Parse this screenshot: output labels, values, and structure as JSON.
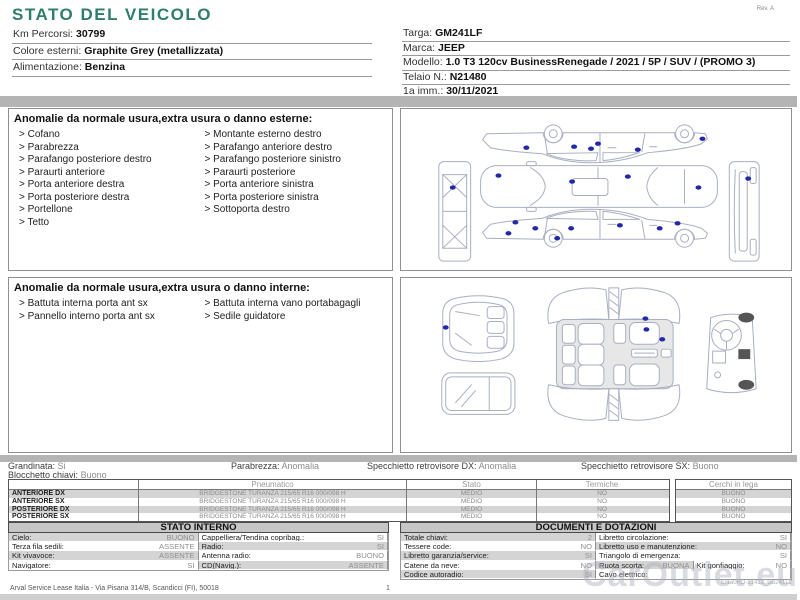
{
  "colors": {
    "accent": "#2f7d6e",
    "bar": "#b4b4b4",
    "dot": "#2328a8",
    "row_shade": "#d4d4d4"
  },
  "header": {
    "title": "STATO DEL VEICOLO",
    "rev": "Rev. A",
    "left_fields": [
      {
        "label": "Km Percorsi:",
        "value": "30799"
      },
      {
        "label": "Colore esterni:",
        "value": "Graphite Grey (metallizzata)"
      },
      {
        "label": "Alimentazione:",
        "value": "Benzina"
      }
    ],
    "right_fields": [
      {
        "label": "Targa:",
        "value": "GM241LF"
      },
      {
        "label": "Marca:",
        "value": "JEEP"
      },
      {
        "label": "Modello:",
        "value": "1.0 T3 120cv BusinessRenegade / 2021 / 5P / SUV / (PROMO 3)"
      },
      {
        "label": "Telaio N.:",
        "value": "N21480"
      },
      {
        "label": "1a imm.:",
        "value": "30/11/2021"
      }
    ]
  },
  "exterior_anomalies": {
    "title": "Anomalie da normale usura,extra usura o danno esterne:",
    "col1": [
      "Cofano",
      "Parabrezza",
      "Parafango posteriore destro",
      "Paraurti anteriore",
      "Porta anteriore destra",
      "Porta posteriore destra",
      "Portellone",
      "Tetto"
    ],
    "col2": [
      "Montante esterno destro",
      "Parafango anteriore destro",
      "Parafango posteriore sinistro",
      "Paraurti posteriore",
      "Porta anteriore sinistra",
      "Porta posteriore sinistra",
      "Sottoporta destro"
    ]
  },
  "interior_anomalies": {
    "title": "Anomalie da normale usura,extra usura o danno interne:",
    "col1": [
      "Battuta interna porta ant sx",
      "Pannello interno porta ant sx"
    ],
    "col2": [
      "Battuta interna vano portabagagli",
      "Sedile guidatore"
    ]
  },
  "diagrams": {
    "exterior_damage_points": [
      [
        126,
        38
      ],
      [
        174,
        37
      ],
      [
        191,
        39
      ],
      [
        198,
        34
      ],
      [
        238,
        40
      ],
      [
        303,
        29
      ],
      [
        98,
        66
      ],
      [
        172,
        72
      ],
      [
        228,
        67
      ],
      [
        299,
        78
      ],
      [
        52,
        78
      ],
      [
        349,
        69
      ],
      [
        108,
        124
      ],
      [
        115,
        113
      ],
      [
        135,
        119
      ],
      [
        157,
        129
      ],
      [
        171,
        119
      ],
      [
        220,
        116
      ],
      [
        260,
        119
      ],
      [
        278,
        114
      ]
    ],
    "interior_damage_points": [
      [
        44,
        50
      ],
      [
        246,
        41
      ],
      [
        247,
        52
      ],
      [
        263,
        62
      ]
    ]
  },
  "summary": {
    "line1": [
      {
        "label": "Grandinata:",
        "value": "Si"
      },
      {
        "label": "Parabrezza:",
        "value": "Anomalia"
      },
      {
        "label": "Specchietto retrovisore DX:",
        "value": "Anomalia"
      },
      {
        "label": "Specchietto retrovisore SX:",
        "value": "Buono"
      }
    ],
    "line2": [
      {
        "label": "Blocchetto chiavi:",
        "value": "Buono"
      }
    ]
  },
  "tyres": {
    "headers": {
      "pneumatico": "Pneumatico",
      "stato": "Stato",
      "termiche": "Termiche",
      "cerchi": "Cerchi in lega"
    },
    "rows": [
      {
        "pos": "ANTERIORE DX",
        "tyre": "BRIDGESTONE TURANZA 215/65 R16 000/098 H",
        "stato": "MEDIO",
        "termiche": "NO",
        "cerchi": "BUONO"
      },
      {
        "pos": "ANTERIORE SX",
        "tyre": "BRIDGESTONE TURANZA 215/65 R16 000/098 H",
        "stato": "MEDIO",
        "termiche": "NO",
        "cerchi": "BUONO"
      },
      {
        "pos": "POSTERIORE DX",
        "tyre": "BRIDGESTONE TURANZA 215/65 R16 000/098 H",
        "stato": "MEDIO",
        "termiche": "NO",
        "cerchi": "BUONO"
      },
      {
        "pos": "POSTERIORE SX",
        "tyre": "BRIDGESTONE TURANZA 215/65 R16 000/098 H",
        "stato": "MEDIO",
        "termiche": "NO",
        "cerchi": "BUONO"
      }
    ]
  },
  "stato_interno": {
    "title": "STATO INTERNO",
    "cells": [
      {
        "label": "Cielo:",
        "value": "BUONO",
        "w": "50%",
        "bg": "g"
      },
      {
        "label": "Cappelliera/Tendina copribag.:",
        "value": "SI",
        "w": "50%",
        "bg": "w"
      },
      {
        "label": "Terza fila sedili:",
        "value": "ASSENTE",
        "w": "50%",
        "bg": "w"
      },
      {
        "label": "Radio:",
        "value": "SI",
        "w": "50%",
        "bg": "g"
      },
      {
        "label": "Kit vivavoce:",
        "value": "ASSENTE",
        "w": "50%",
        "bg": "g"
      },
      {
        "label": "Antenna radio:",
        "value": "BUONO",
        "w": "50%",
        "bg": "w"
      },
      {
        "label": "Navigatore:",
        "value": "SI",
        "w": "50%",
        "bg": "w"
      },
      {
        "label": "CD(Navig.):",
        "value": "ASSENTE",
        "w": "50%",
        "bg": "g"
      }
    ]
  },
  "documenti": {
    "title": "DOCUMENTI E DOTAZIONI",
    "cells": [
      {
        "label": "Totale chiavi:",
        "value": "2",
        "w": "50%",
        "bg": "g"
      },
      {
        "label": "Libretto circolazione:",
        "value": "SI",
        "w": "50%",
        "bg": "w"
      },
      {
        "label": "Tessere code:",
        "value": "NO",
        "w": "50%",
        "bg": "w"
      },
      {
        "label": "Libretto uso e manutenzione:",
        "value": "NO",
        "w": "50%",
        "bg": "g"
      },
      {
        "label": "Libretto garanzia/service:",
        "value": "SI",
        "w": "50%",
        "bg": "g"
      },
      {
        "label": "Triangolo di emergenza:",
        "value": "SI",
        "w": "50%",
        "bg": "w"
      },
      {
        "label": "Catene da neve:",
        "value": "NO",
        "w": "50%",
        "bg": "w"
      },
      {
        "label": "Ruota scorta:",
        "value": "BUONA",
        "w": "25%",
        "bg": "g"
      },
      {
        "label": "Kit gonfiaggio:",
        "value": "NO",
        "w": "25%",
        "bg": "w"
      },
      {
        "label": "Codice autoradio:",
        "value": "SI",
        "w": "50%",
        "bg": "g"
      },
      {
        "label": "Cavo elettrico:",
        "value": "",
        "w": "50%",
        "bg": "w"
      }
    ]
  },
  "footer": {
    "company": "Arval Service Lease Italia - Via Pisana 314/B, Scandicci (FI), 50018",
    "page": "1"
  },
  "watermark": {
    "text": "CarOutlet.eu",
    "id_line": "ID1a0RD-21412_Gb241L2"
  }
}
